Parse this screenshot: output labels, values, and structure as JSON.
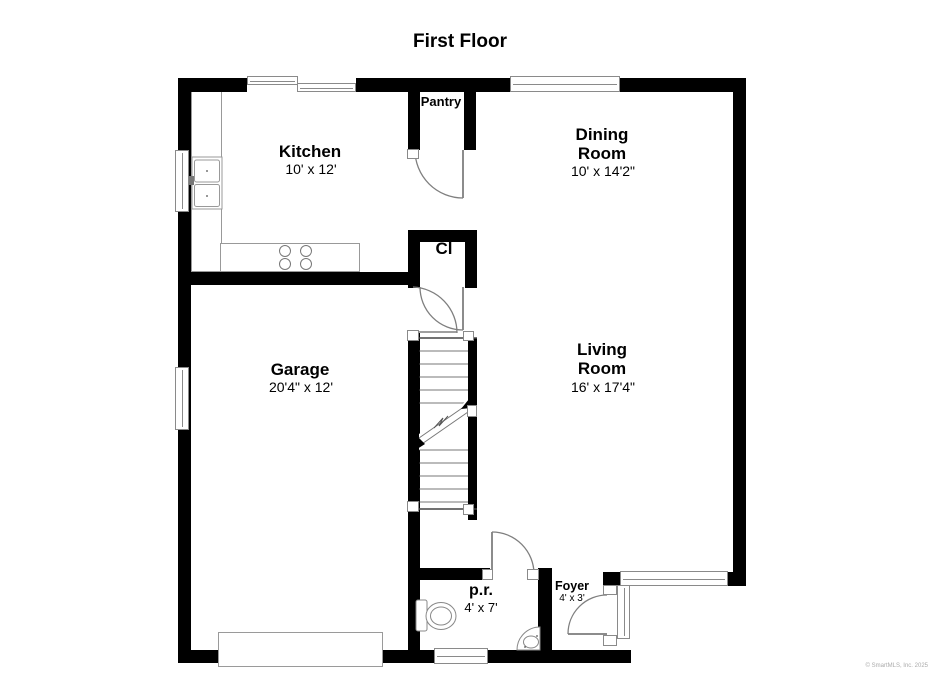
{
  "title": "First Floor",
  "watermark": "© SmartMLS, Inc. 2025",
  "colors": {
    "wall": "#000000",
    "background": "#ffffff",
    "fixture_line": "#8a8a8a",
    "text": "#000000"
  },
  "rooms": {
    "kitchen": {
      "name": "Kitchen",
      "dims": "10' x 12'"
    },
    "pantry": {
      "name": "Pantry"
    },
    "dining_room": {
      "name": "Dining\nRoom",
      "dims": "10' x 14'2\""
    },
    "closet": {
      "name": "Cl"
    },
    "garage": {
      "name": "Garage",
      "dims": "20'4\" x 12'"
    },
    "living_room": {
      "name": "Living\nRoom",
      "dims": "16' x 17'4\""
    },
    "powder_room": {
      "name": "p.r.",
      "dims": "4' x 7'"
    },
    "foyer": {
      "name": "Foyer",
      "dims": "4' x 3'"
    }
  }
}
